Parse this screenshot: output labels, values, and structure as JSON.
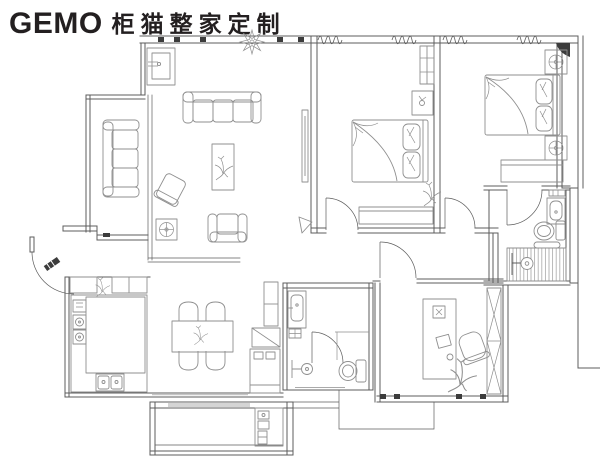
{
  "logo": {
    "brand": "GEMO",
    "tagline": "柜猫整家定制"
  },
  "colors": {
    "background": "#ffffff",
    "walls": "#5c5c5c",
    "furniture": "#8f8f8f",
    "accents": "#3c3c3c",
    "logo": "#231f20"
  },
  "plan": {
    "type": "apartment-floor-plan",
    "fixtures": [
      "entry-door",
      "three-seat-sofa",
      "side-sofa",
      "coffee-table",
      "armchair",
      "lounge-chair",
      "floor-lamp",
      "tv-panel",
      "wash-basin-niche",
      "railing-posts",
      "decor-plant",
      "kitchen-counter",
      "kitchen-sink",
      "cooktop",
      "wall-cabinets",
      "dining-table",
      "dining-chairs",
      "tall-cabinet",
      "fridge",
      "bathroom-vanity",
      "toilet",
      "shower-head",
      "shower-area",
      "desk",
      "monitor",
      "keyboard",
      "mouse",
      "office-chair",
      "wardrobe",
      "double-bed",
      "pillows",
      "nightstand",
      "table-lamp",
      "dresser",
      "window-coils",
      "balcony",
      "laundry-cabinet"
    ]
  }
}
